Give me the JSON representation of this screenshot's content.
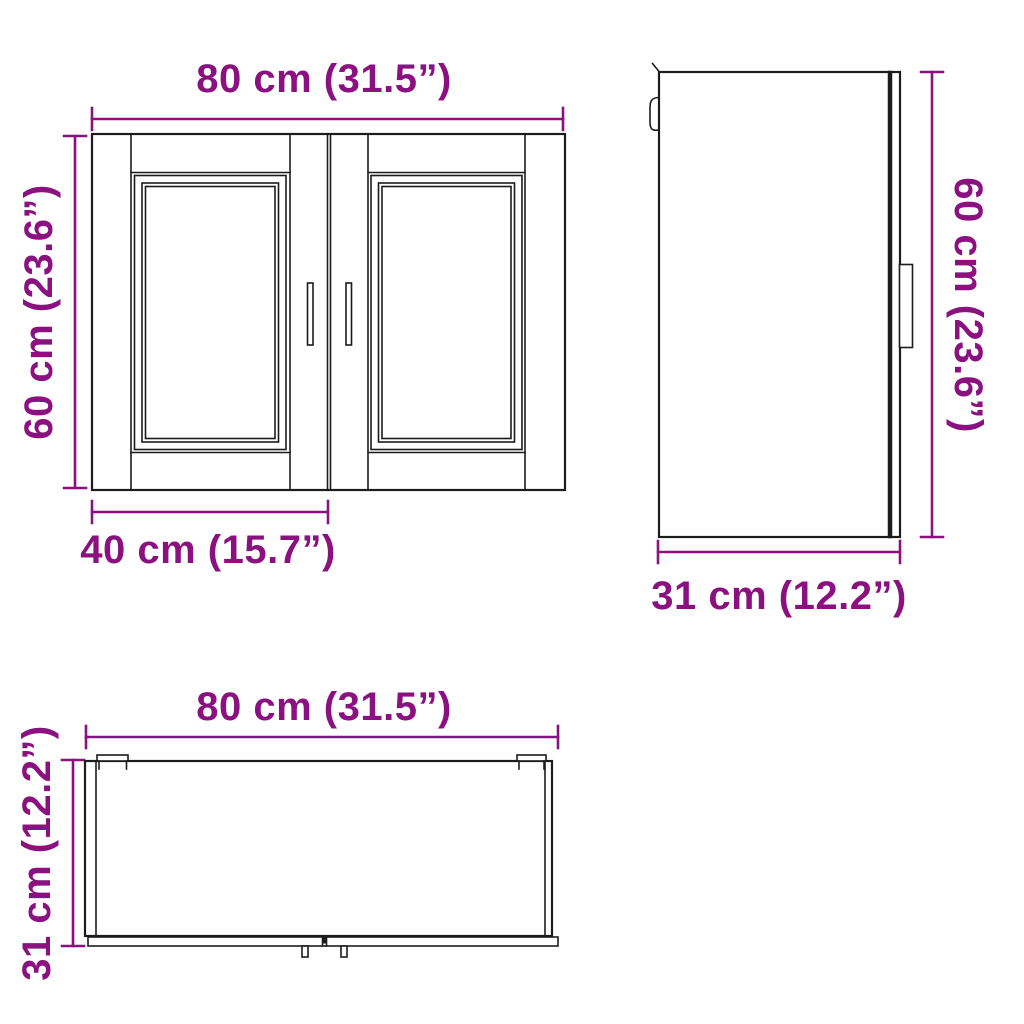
{
  "colors": {
    "dimension": "#8B1180",
    "line": "#1c1c1c",
    "background": "#ffffff"
  },
  "views": {
    "front": {
      "width_label": "80 cm (31.5”)",
      "height_label": "60 cm (23.6”)",
      "door_width_label": "40 cm (15.7”)"
    },
    "side": {
      "height_label": "60 cm (23.6”)",
      "depth_label": "31 cm (12.2”)"
    },
    "top": {
      "width_label": "80 cm (31.5”)",
      "depth_label": "31 cm (12.2”)"
    }
  },
  "dimensions": {
    "width": {
      "cm": 80,
      "inches": 31.5
    },
    "height": {
      "cm": 60,
      "inches": 23.6
    },
    "depth": {
      "cm": 31,
      "inches": 12.2
    },
    "door_width": {
      "cm": 40,
      "inches": 15.7
    }
  }
}
